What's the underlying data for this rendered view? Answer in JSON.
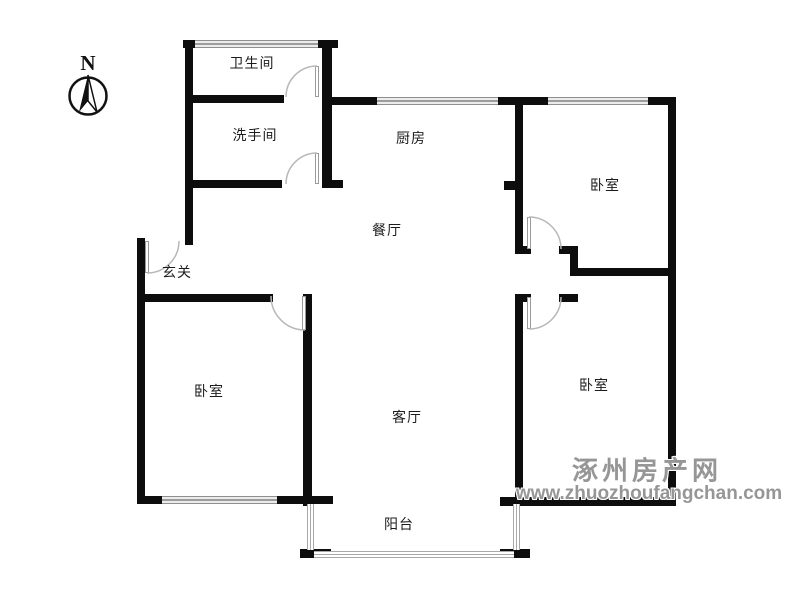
{
  "compass": {
    "north_label": "N"
  },
  "rooms": [
    {
      "id": "bathroom",
      "label": "卫生间"
    },
    {
      "id": "washroom",
      "label": "洗手间"
    },
    {
      "id": "kitchen",
      "label": "厨房"
    },
    {
      "id": "bedroom-north",
      "label": "卧室"
    },
    {
      "id": "dining-room",
      "label": "餐厅"
    },
    {
      "id": "entry-hall",
      "label": "玄关"
    },
    {
      "id": "bedroom-west",
      "label": "卧室"
    },
    {
      "id": "living-room",
      "label": "客厅"
    },
    {
      "id": "bedroom-south",
      "label": "卧室"
    },
    {
      "id": "balcony",
      "label": "阳台"
    }
  ],
  "watermark": {
    "site_name": "涿州房产网",
    "url": "www.zhuozhoufangchan.com"
  },
  "colors": {
    "wall": "#0d0d0d",
    "window_line": "#8f8f8f",
    "door_arc": "#b8b8b8",
    "watermark": "#969696",
    "background": "#ffffff"
  }
}
